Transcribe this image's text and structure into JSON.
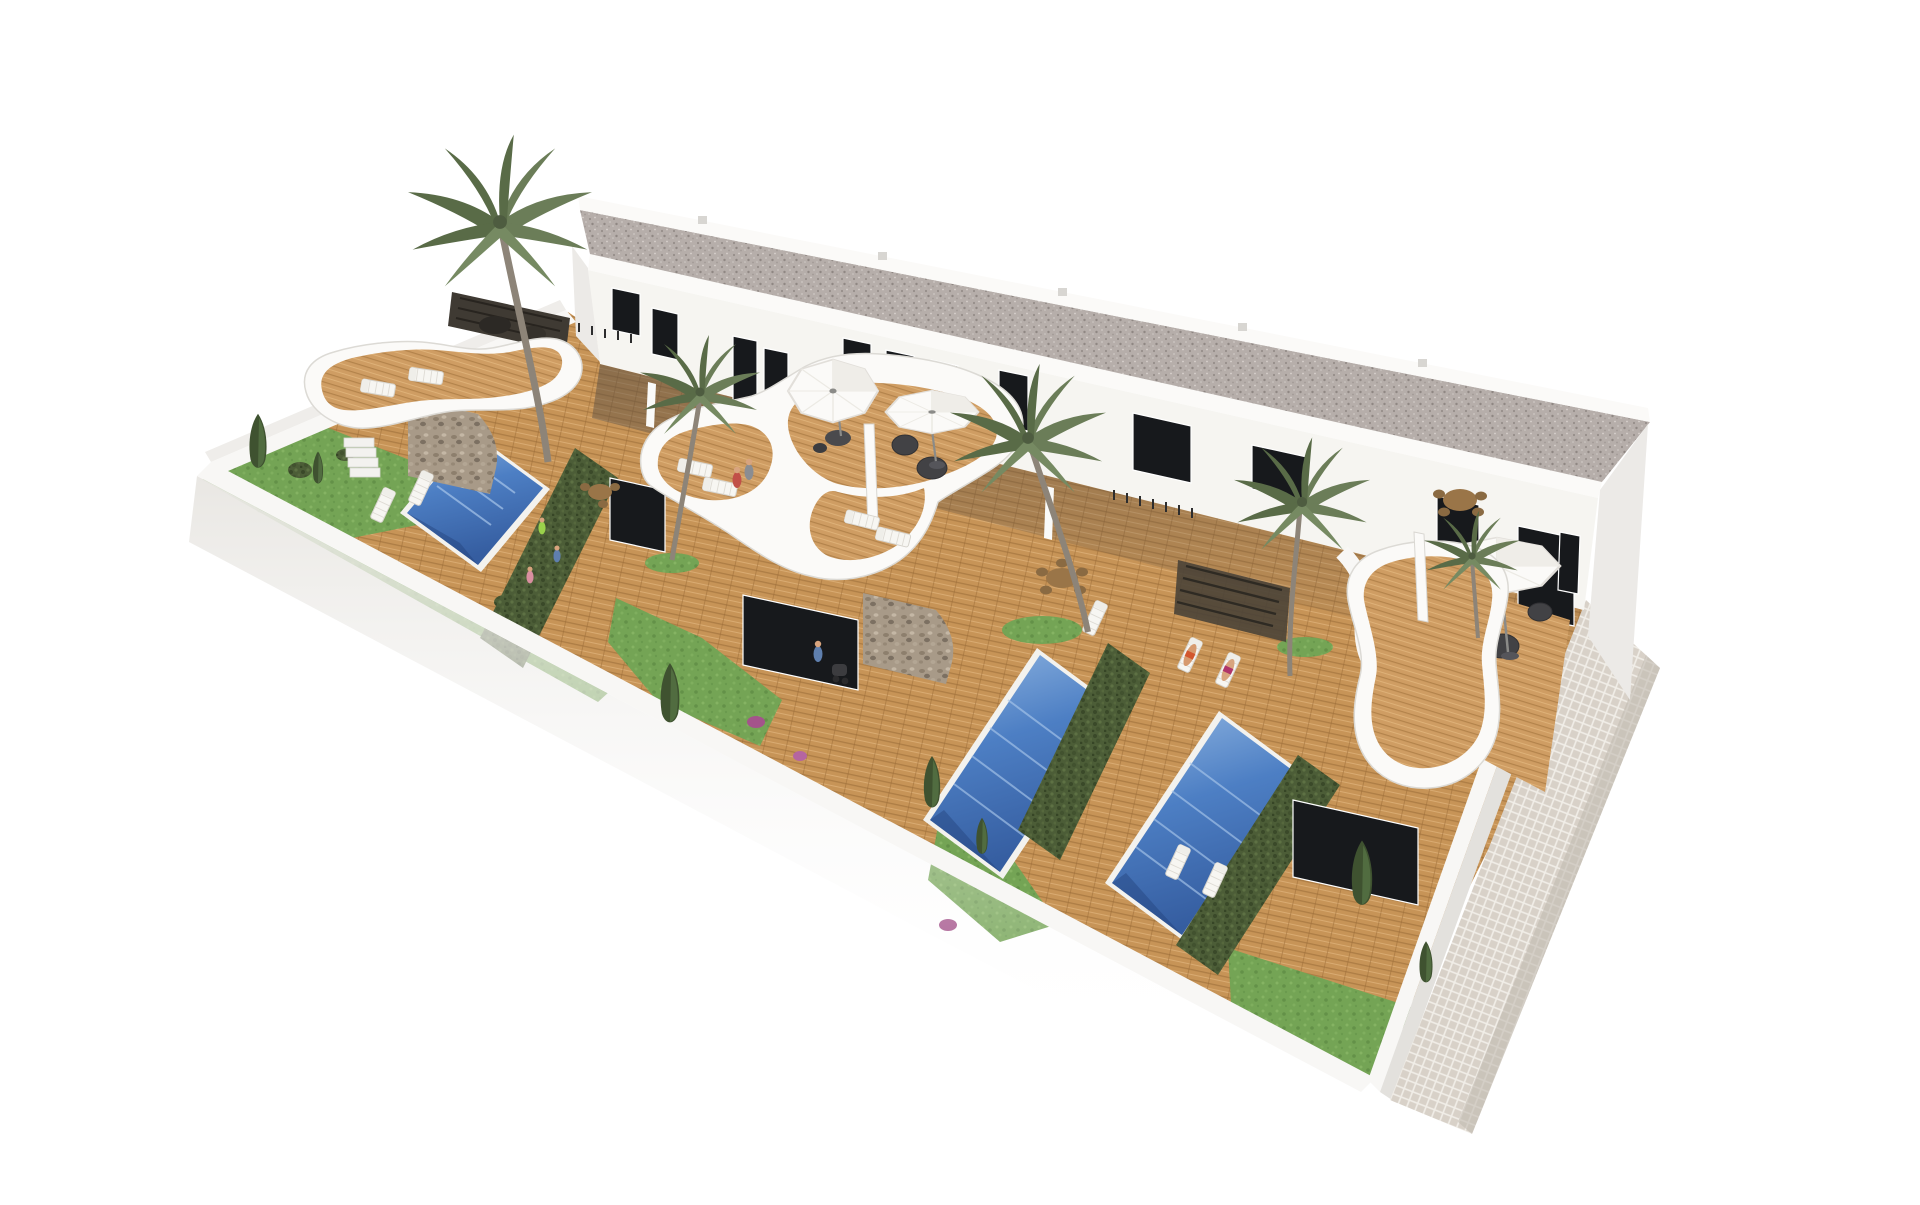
{
  "meta": {
    "title": "Aerial 3D render - white terraced villas with private pools",
    "background": "#ffffff"
  },
  "scene": {
    "description": "Aerial 3D architectural rendering of a row of modern white two-storey holiday townhouses with a grey gravel flat roof, curved white roof terraces with timber decks, private walled gardens with wooden decking, three rectangular blue swimming pools, separating hedges, palm and cypress trees, white sun loungers, white parasols and a mosaic tiled walkway along the lower right side, on a plain white background",
    "style": "photorealistic computer render, perspective aerial view",
    "building": {
      "storeys": 2,
      "roof": "flat gravel",
      "windows_visible": 13,
      "materials": [
        "white render",
        "natural stone cladding",
        "timber decking",
        "glass",
        "gravel",
        "ceramic tiles"
      ]
    },
    "inventory": {
      "swimming_pools": 3,
      "roof_terraces": 3,
      "parasols": 3,
      "sun_loungers": 15,
      "palm_trees": 5,
      "cypress_trees": 7,
      "dining_sets": 3,
      "people": 8,
      "stroller": 1
    }
  },
  "colors": {
    "page_bg": "#ffffff",
    "wall_white": "#f8f7f5",
    "wall_face": "#edebe7",
    "facade": "#f6f5f1",
    "parapet": "#fbfaf8",
    "roof_gravel": "#b6aeaa",
    "window_glass": "#17191c",
    "wood_mid": "#c79457",
    "wood_light": "#d9ab72",
    "pool_blue": "#4d7fc4",
    "pool_deep": "#355da0",
    "hedge_green": "#4c5d37",
    "grass_green": "#74a455",
    "stone_clad": "#a89a88",
    "palm_green": "#6b7d58",
    "tile_path": "#d8d1c8",
    "furniture_dark": "#424245",
    "skin_tone": "#d8a47e"
  }
}
